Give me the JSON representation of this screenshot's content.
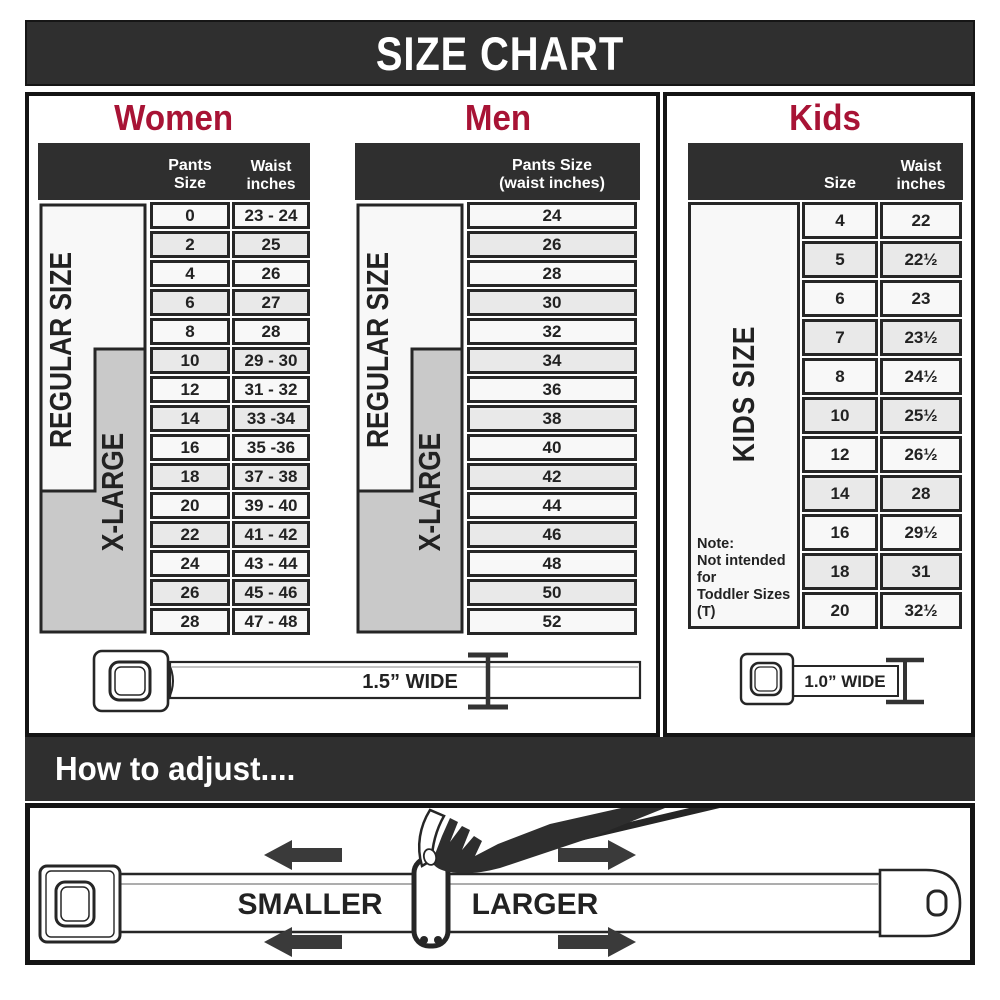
{
  "title": "SIZE CHART",
  "colors": {
    "accent_red": "#A81335",
    "dark_bar": "#2F2F2F",
    "xlarge_gray": "#C9C9C9",
    "row_light": "#F8F8F8",
    "row_alt": "#E9E9E9"
  },
  "women": {
    "heading": "Women",
    "col1": "Pants Size",
    "col2_line1": "Waist",
    "col2_line2": "inches",
    "regular_label": "REGULAR SIZE",
    "xlarge_label": "X-LARGE",
    "rows": [
      {
        "size": "0",
        "waist": "23 - 24"
      },
      {
        "size": "2",
        "waist": "25"
      },
      {
        "size": "4",
        "waist": "26"
      },
      {
        "size": "6",
        "waist": "27"
      },
      {
        "size": "8",
        "waist": "28"
      },
      {
        "size": "10",
        "waist": "29 - 30"
      },
      {
        "size": "12",
        "waist": "31 - 32"
      },
      {
        "size": "14",
        "waist": "33 -34"
      },
      {
        "size": "16",
        "waist": "35 -36"
      },
      {
        "size": "18",
        "waist": "37 - 38"
      },
      {
        "size": "20",
        "waist": "39 - 40"
      },
      {
        "size": "22",
        "waist": "41 - 42"
      },
      {
        "size": "24",
        "waist": "43 - 44"
      },
      {
        "size": "26",
        "waist": "45 - 46"
      },
      {
        "size": "28",
        "waist": "47 - 48"
      }
    ]
  },
  "men": {
    "heading": "Men",
    "header_line1": "Pants Size",
    "header_line2": "(waist inches)",
    "regular_label": "REGULAR SIZE",
    "xlarge_label": "X-LARGE",
    "rows": [
      "24",
      "26",
      "28",
      "30",
      "32",
      "34",
      "36",
      "38",
      "40",
      "42",
      "44",
      "46",
      "48",
      "50",
      "52"
    ]
  },
  "kids": {
    "heading": "Kids",
    "col1": "Size",
    "col2_line1": "Waist",
    "col2_line2": "inches",
    "side_label": "KIDS SIZE",
    "note_line1": "Note:",
    "note_line2": "Not intended for",
    "note_line3": "Toddler Sizes (T)",
    "rows": [
      {
        "size": "4",
        "waist": "22"
      },
      {
        "size": "5",
        "waist": "22½"
      },
      {
        "size": "6",
        "waist": "23"
      },
      {
        "size": "7",
        "waist": "23½"
      },
      {
        "size": "8",
        "waist": "24½"
      },
      {
        "size": "10",
        "waist": "25½"
      },
      {
        "size": "12",
        "waist": "26½"
      },
      {
        "size": "14",
        "waist": "28"
      },
      {
        "size": "16",
        "waist": "29½"
      },
      {
        "size": "18",
        "waist": "31"
      },
      {
        "size": "20",
        "waist": "32½"
      }
    ]
  },
  "belts": {
    "adult_width_label": "1.5” WIDE",
    "kids_width_label": "1.0” WIDE"
  },
  "how_to_adjust": {
    "heading": "How to adjust....",
    "smaller_label": "SMALLER",
    "larger_label": "LARGER"
  }
}
